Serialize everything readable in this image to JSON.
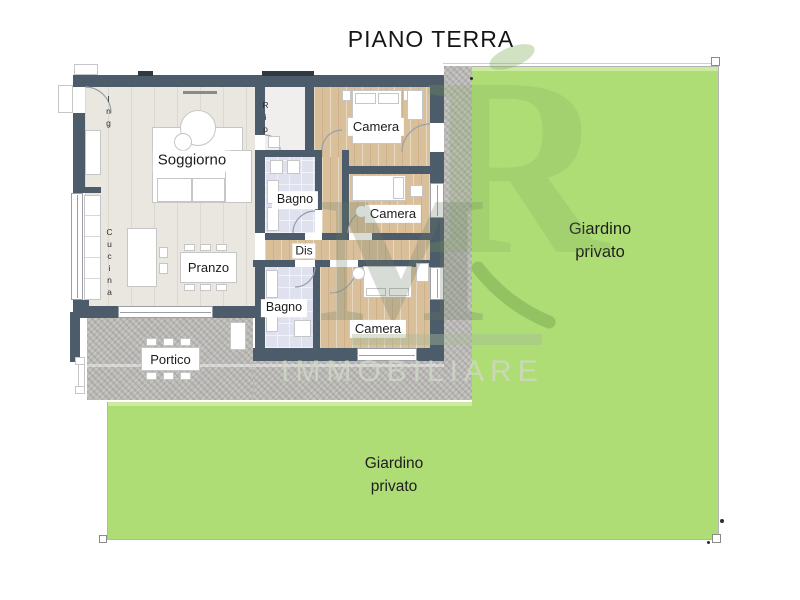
{
  "title": "PIANO TERRA",
  "plan": {
    "rooms": {
      "ingresso": {
        "label": "Ing"
      },
      "soggiorno": {
        "label": "Soggiorno"
      },
      "cucina": {
        "label": "Cucina"
      },
      "pranzo": {
        "label": "Pranzo"
      },
      "ripostiglio": {
        "label": "Rip"
      },
      "camera1": {
        "label": "Camera"
      },
      "camera2": {
        "label": "Camera"
      },
      "camera3": {
        "label": "Camera"
      },
      "bagno1": {
        "label": "Bagno"
      },
      "bagno2": {
        "label": "Bagno"
      },
      "disimpegno": {
        "label": "Dis"
      },
      "portico": {
        "label": "Portico"
      }
    }
  },
  "gardens": {
    "right": {
      "line1": "Giardino",
      "line2": "privato"
    },
    "bottom": {
      "line1": "Giardino",
      "line2": "privato"
    }
  },
  "watermark": {
    "monogram_m": "M",
    "monogram_r": "R",
    "wordmark": "IMMOBILIARE"
  },
  "colors": {
    "wall": "#4d5c6a",
    "window_marker": "#2f3a42",
    "garden_green": "#aedd76",
    "gravel": "#bcbab7",
    "wood_light": "#eae7e1",
    "wood_bedroom": "#d9c09b",
    "bathroom_floor": "#dfe2ee",
    "watermark_green": "#7cb55a"
  }
}
